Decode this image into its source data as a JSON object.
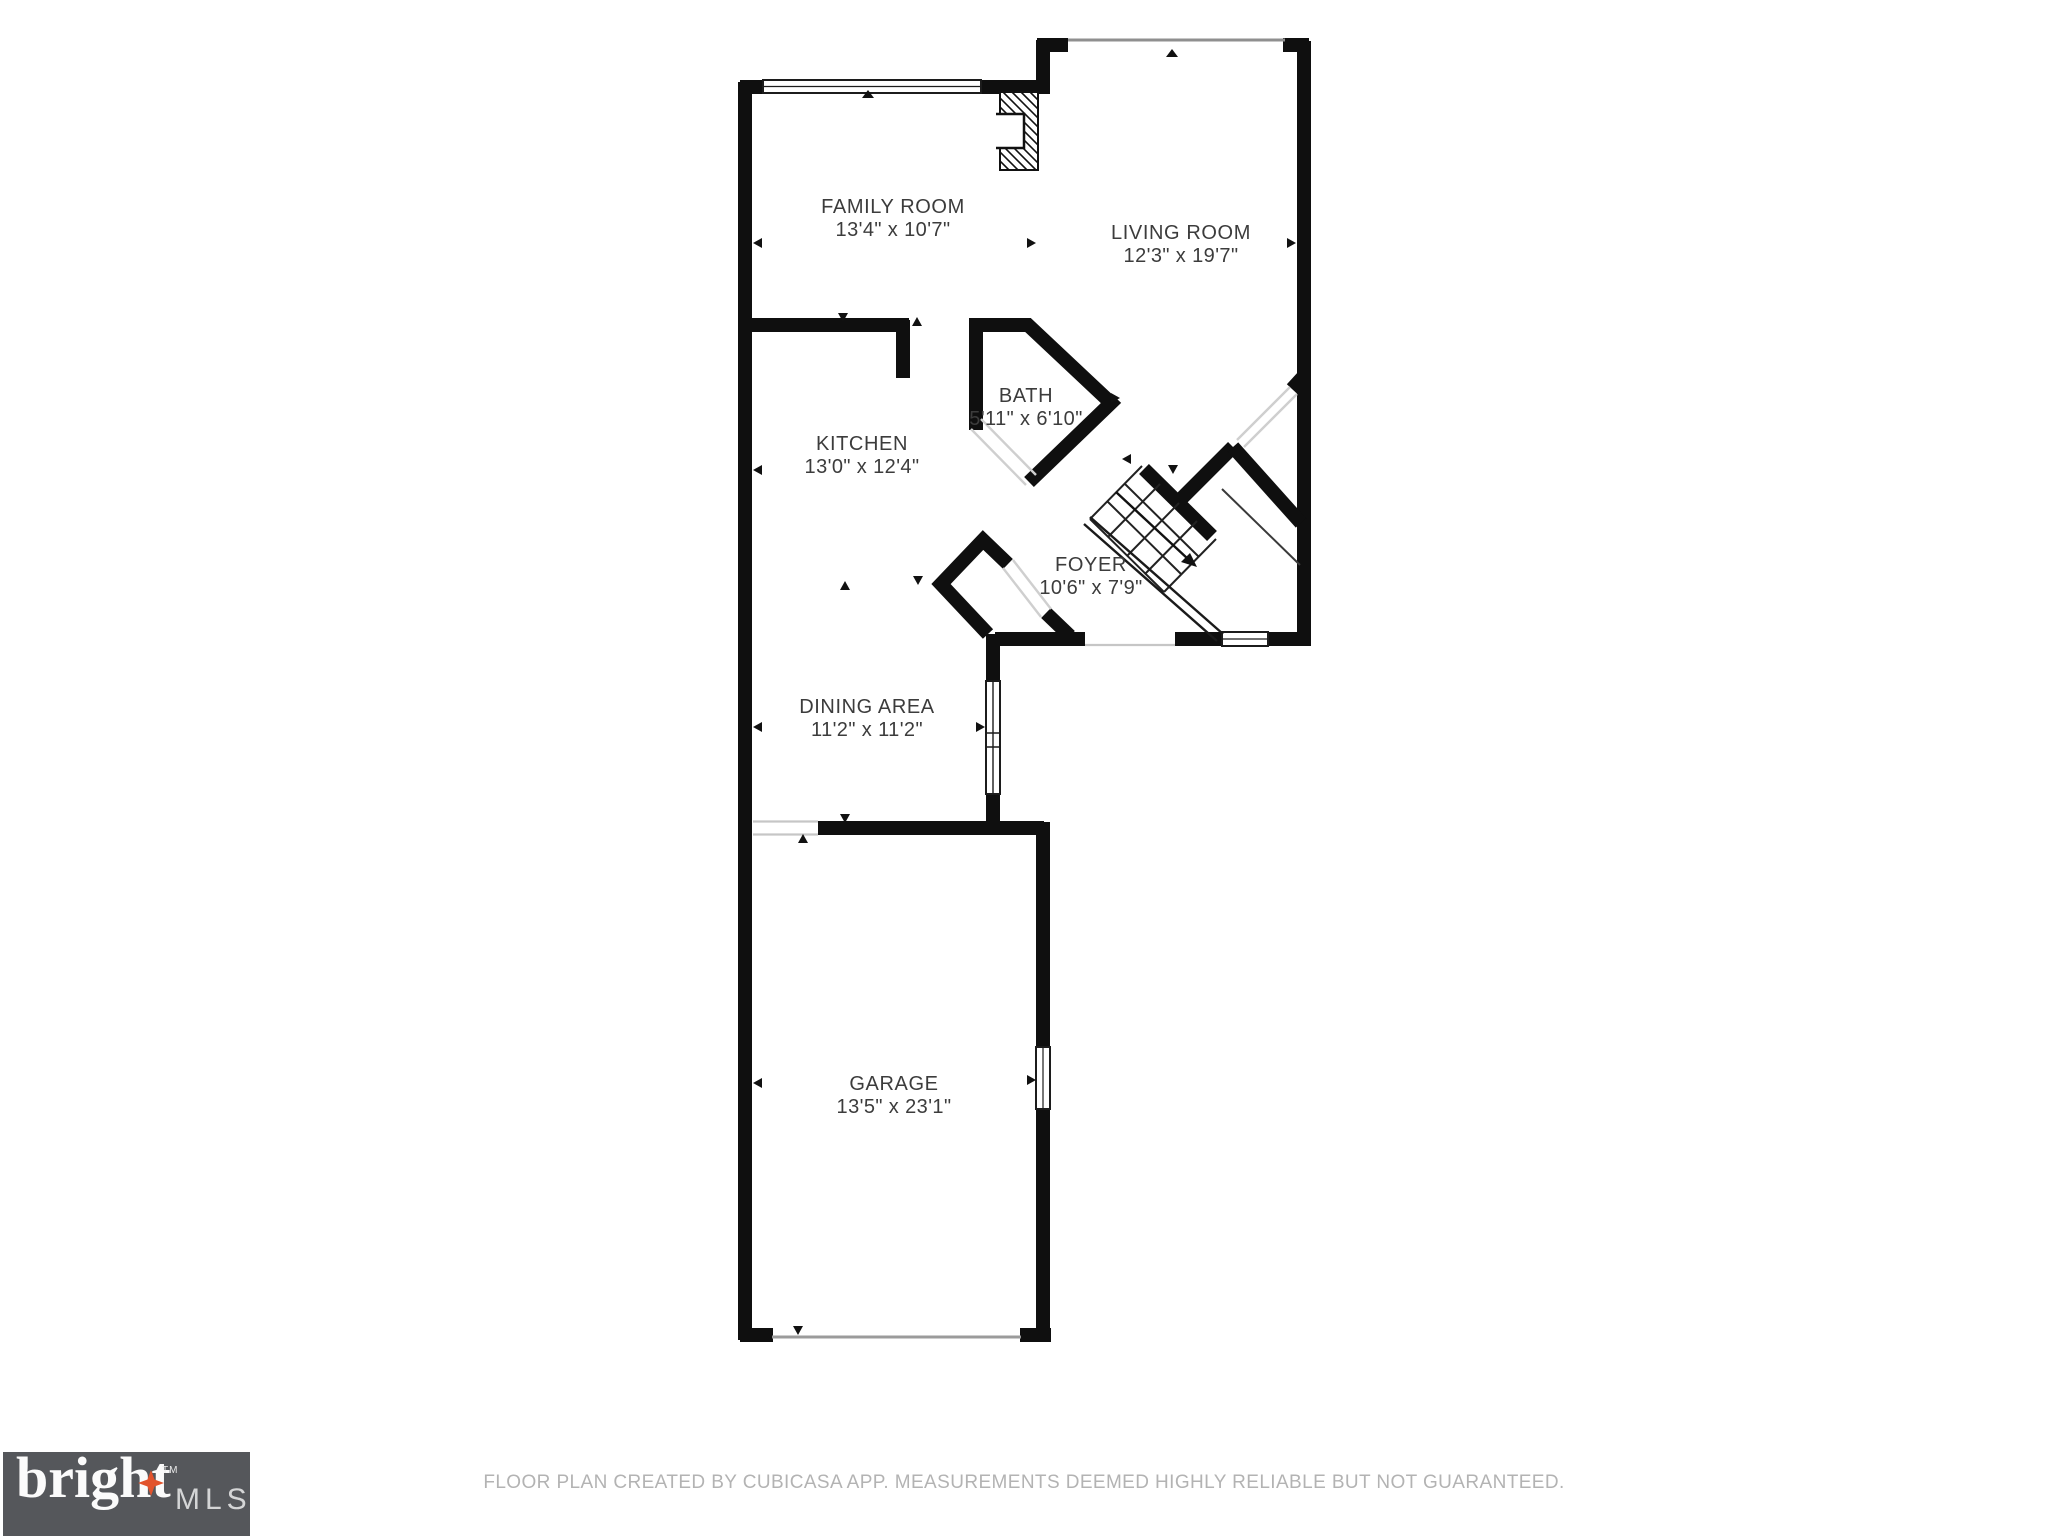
{
  "page": {
    "type": "floor-plan"
  },
  "rooms": [
    {
      "name": "FAMILY ROOM",
      "dims": "13'4\" x 10'7\""
    },
    {
      "name": "LIVING ROOM",
      "dims": "12'3\" x 19'7\""
    },
    {
      "name": "KITCHEN",
      "dims": "13'0\" x 12'4\""
    },
    {
      "name": "BATH",
      "dims": "5'11\" x 6'10\""
    },
    {
      "name": "FOYER",
      "dims": "10'6\" x 7'9\""
    },
    {
      "name": "DINING AREA",
      "dims": "11'2\" x 11'2\""
    },
    {
      "name": "GARAGE",
      "dims": "13'5\" x 23'1\""
    }
  ],
  "footer": {
    "disclaimer": "FLOOR PLAN CREATED BY CUBICASA APP. MEASUREMENTS DEEMED HIGHLY RELIABLE BUT NOT GUARANTEED."
  },
  "logo": {
    "brand": "bright",
    "tm": "TM",
    "suffix": "MLS",
    "star_color": "#e2532c",
    "bg_color": "#55575b"
  },
  "colors": {
    "wall": "#0f0f0f",
    "label_text": "#3c3c3c",
    "disclaimer_text": "#b3b3b3"
  }
}
